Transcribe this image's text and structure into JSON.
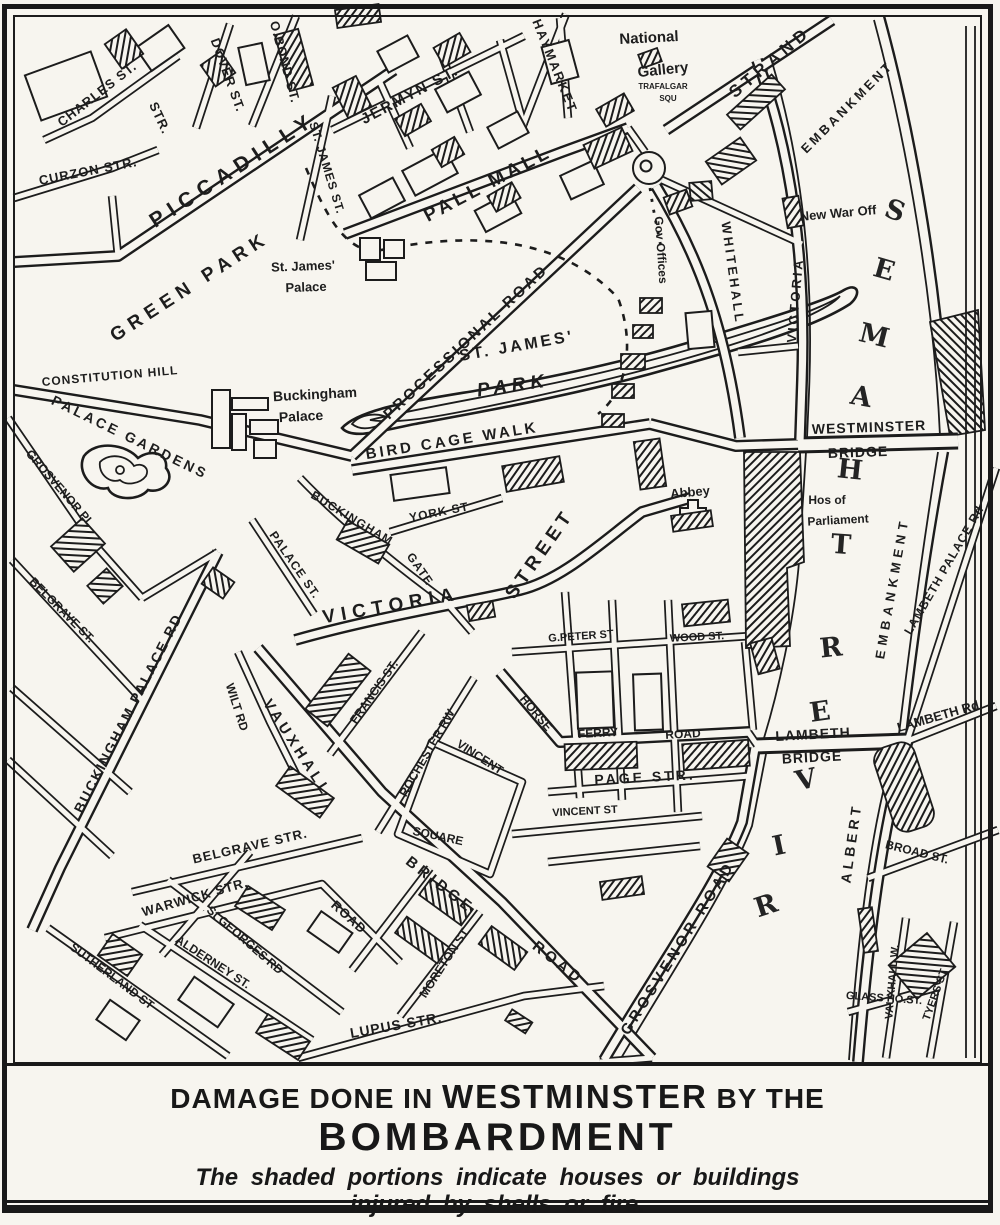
{
  "colors": {
    "ink": "#1c1c1c",
    "paper": "#f7f5ef"
  },
  "caption": {
    "line1_prefix": "DAMAGE DONE IN ",
    "line1_emphasis": "WESTMINSTER",
    "line1_suffix": " BY THE",
    "line2": "BOMBARDMENT",
    "note1": "The shaded portions indicate houses or buildings",
    "note2": "injured by shells or fire."
  },
  "labels": [
    {
      "name": "charles-street",
      "text": "CHARLES ST.",
      "x": 97,
      "y": 94,
      "rot": -38,
      "size": 13,
      "ls": 1
    },
    {
      "name": "str-fragment",
      "text": "STR.",
      "x": 160,
      "y": 118,
      "rot": 65,
      "size": 13,
      "ls": 1
    },
    {
      "name": "curzon-street",
      "text": "CURZON STR.",
      "x": 88,
      "y": 171,
      "rot": -11,
      "size": 13,
      "ls": 1
    },
    {
      "name": "dover-street",
      "text": "DOVER ST.",
      "x": 228,
      "y": 75,
      "rot": 70,
      "size": 13,
      "ls": 1
    },
    {
      "name": "old-bond-street",
      "text": "O.BOND ST.",
      "x": 285,
      "y": 62,
      "rot": 75,
      "size": 13,
      "ls": 1
    },
    {
      "name": "piccadilly",
      "text": "PICCADILLY",
      "x": 233,
      "y": 170,
      "rot": -33,
      "size": 21,
      "ls": 7
    },
    {
      "name": "st-james-street",
      "text": "ST. JAMES ST.",
      "x": 327,
      "y": 168,
      "rot": 73,
      "size": 12,
      "ls": 1
    },
    {
      "name": "jermyn-street",
      "text": "JERMYN ST.",
      "x": 410,
      "y": 95,
      "rot": -28,
      "size": 15,
      "ls": 2
    },
    {
      "name": "haymarket",
      "text": "HAYMARKET",
      "x": 555,
      "y": 66,
      "rot": 68,
      "size": 13,
      "ls": 2
    },
    {
      "name": "pall-mall",
      "text": "PALL MALL",
      "x": 488,
      "y": 184,
      "rot": -28,
      "size": 19,
      "ls": 4
    },
    {
      "name": "national-gallery-line1",
      "text": "National",
      "x": 649,
      "y": 38,
      "rot": -3,
      "size": 15
    },
    {
      "name": "national-gallery-line2",
      "text": "Gallery",
      "x": 663,
      "y": 70,
      "rot": -6,
      "size": 15
    },
    {
      "name": "trafalgar-square-line1",
      "text": "TRAFALGAR",
      "x": 663,
      "y": 87,
      "rot": 0,
      "size": 8
    },
    {
      "name": "trafalgar-square-line2",
      "text": "SQU",
      "x": 668,
      "y": 99,
      "rot": 0,
      "size": 8
    },
    {
      "name": "strand",
      "text": "STRAND",
      "x": 770,
      "y": 62,
      "rot": -40,
      "size": 17,
      "ls": 5
    },
    {
      "name": "victoria-embankment-part1",
      "text": "VICTORIA",
      "x": 795,
      "y": 300,
      "rot": -85,
      "size": 13,
      "ls": 3
    },
    {
      "name": "victoria-embankment-part2",
      "text": "EMBANKMENT",
      "x": 847,
      "y": 107,
      "rot": -45,
      "size": 13,
      "ls": 3
    },
    {
      "name": "new-war-office",
      "text": "New War Off",
      "x": 838,
      "y": 213,
      "rot": -5,
      "size": 13
    },
    {
      "name": "whitehall",
      "text": "WHITEHALL",
      "x": 733,
      "y": 273,
      "rot": 82,
      "size": 13,
      "ls": 3
    },
    {
      "name": "gov-offices",
      "text": "Gov Offices",
      "x": 661,
      "y": 250,
      "rot": 86,
      "size": 12
    },
    {
      "name": "green-park",
      "text": "GREEN PARK",
      "x": 190,
      "y": 287,
      "rot": -33,
      "size": 19,
      "ls": 6
    },
    {
      "name": "st-james-palace-line1",
      "text": "St. James'",
      "x": 303,
      "y": 266,
      "rot": -2,
      "size": 13
    },
    {
      "name": "st-james-palace-line2",
      "text": "Palace",
      "x": 306,
      "y": 287,
      "rot": -2,
      "size": 13
    },
    {
      "name": "processional-road",
      "text": "PROCESSIONAL ROAD",
      "x": 466,
      "y": 342,
      "rot": -43,
      "size": 15,
      "ls": 3
    },
    {
      "name": "constitution-hill",
      "text": "CONSTITUTION HILL",
      "x": 110,
      "y": 376,
      "rot": -5,
      "size": 12,
      "ls": 1
    },
    {
      "name": "palace-gardens",
      "text": "PALACE GARDENS",
      "x": 130,
      "y": 437,
      "rot": 26,
      "size": 14,
      "ls": 3
    },
    {
      "name": "buckingham-palace-line1",
      "text": "Buckingham",
      "x": 315,
      "y": 394,
      "rot": -3,
      "size": 14
    },
    {
      "name": "buckingham-palace-line2",
      "text": "Palace",
      "x": 301,
      "y": 416,
      "rot": -3,
      "size": 14
    },
    {
      "name": "st-james-park-line1",
      "text": "ST. JAMES'",
      "x": 517,
      "y": 347,
      "rot": -10,
      "size": 16,
      "ls": 3
    },
    {
      "name": "st-james-park-line2",
      "text": "PARK",
      "x": 513,
      "y": 386,
      "rot": -8,
      "size": 19,
      "ls": 5,
      "italic": true
    },
    {
      "name": "bird-cage-walk",
      "text": "BIRD CAGE WALK",
      "x": 452,
      "y": 441,
      "rot": -9,
      "size": 15,
      "ls": 3
    },
    {
      "name": "york-street",
      "text": "YORK ST",
      "x": 439,
      "y": 512,
      "rot": -11,
      "size": 12,
      "ls": 1
    },
    {
      "name": "buckingham-gate-part1",
      "text": "BUCKINGHAM",
      "x": 352,
      "y": 518,
      "rot": 31,
      "size": 12,
      "ls": 1
    },
    {
      "name": "buckingham-gate-part2",
      "text": "GATE",
      "x": 420,
      "y": 569,
      "rot": 55,
      "size": 12,
      "ls": 1
    },
    {
      "name": "palace-street",
      "text": "PALACE ST.",
      "x": 295,
      "y": 565,
      "rot": 55,
      "size": 12,
      "ls": 1
    },
    {
      "name": "victoria-street-part1",
      "text": "VICTORIA",
      "x": 391,
      "y": 606,
      "rot": -10,
      "size": 19,
      "ls": 6
    },
    {
      "name": "victoria-street-part2",
      "text": "STREET",
      "x": 540,
      "y": 554,
      "rot": -55,
      "size": 19,
      "ls": 5
    },
    {
      "name": "westminster-bridge-line1",
      "text": "WESTMINSTER",
      "x": 869,
      "y": 427,
      "rot": -2,
      "size": 14,
      "ls": 1
    },
    {
      "name": "westminster-bridge-line2",
      "text": "BRIDGE",
      "x": 858,
      "y": 452,
      "rot": -2,
      "size": 14,
      "ls": 1
    },
    {
      "name": "abbey",
      "text": "Abbey",
      "x": 690,
      "y": 492,
      "rot": -5,
      "size": 13
    },
    {
      "name": "houses-of-parliament-line1",
      "text": "Hos of",
      "x": 827,
      "y": 500,
      "rot": 0,
      "size": 12
    },
    {
      "name": "houses-of-parliament-line2",
      "text": "Parliament",
      "x": 838,
      "y": 520,
      "rot": -3,
      "size": 12
    },
    {
      "name": "gt-peter-street",
      "text": "G.PETER ST",
      "x": 581,
      "y": 637,
      "rot": -4,
      "size": 11
    },
    {
      "name": "wood-street",
      "text": "WOOD ST.",
      "x": 697,
      "y": 638,
      "rot": -3,
      "size": 11
    },
    {
      "name": "horseferry-road-part1",
      "text": "HORSE",
      "x": 536,
      "y": 713,
      "rot": 50,
      "size": 12
    },
    {
      "name": "horseferry-road-part2",
      "text": "FERRY",
      "x": 598,
      "y": 733,
      "rot": -3,
      "size": 12
    },
    {
      "name": "horseferry-road-part3",
      "text": "ROAD",
      "x": 683,
      "y": 734,
      "rot": -3,
      "size": 12
    },
    {
      "name": "page-street",
      "text": "PAGE STR.",
      "x": 645,
      "y": 777,
      "rot": -3,
      "size": 14,
      "ls": 3
    },
    {
      "name": "vincent-street",
      "text": "VINCENT ST",
      "x": 585,
      "y": 812,
      "rot": -3,
      "size": 11
    },
    {
      "name": "vincent-square-part1",
      "text": "VINCENT",
      "x": 480,
      "y": 757,
      "rot": 33,
      "size": 12
    },
    {
      "name": "vincent-square-part2",
      "text": "SQUARE",
      "x": 438,
      "y": 836,
      "rot": 12,
      "size": 12
    },
    {
      "name": "francis-street",
      "text": "FRANCIS ST.",
      "x": 374,
      "y": 692,
      "rot": -55,
      "size": 12
    },
    {
      "name": "rochester-row",
      "text": "ROCHESTER RW",
      "x": 427,
      "y": 753,
      "rot": -60,
      "size": 12
    },
    {
      "name": "wilton-road",
      "text": "WILT RD",
      "x": 237,
      "y": 707,
      "rot": 72,
      "size": 12
    },
    {
      "name": "vauxhall-bridge-road-part1",
      "text": "VAUXHALL",
      "x": 297,
      "y": 748,
      "rot": 57,
      "size": 15,
      "ls": 4
    },
    {
      "name": "vauxhall-bridge-road-part2",
      "text": "BRIDGE",
      "x": 440,
      "y": 885,
      "rot": 38,
      "size": 15,
      "ls": 4
    },
    {
      "name": "vauxhall-bridge-road-part3",
      "text": "ROAD",
      "x": 558,
      "y": 963,
      "rot": 38,
      "size": 15,
      "ls": 4
    },
    {
      "name": "belgrave-street",
      "text": "BELGRAVE ST.",
      "x": 62,
      "y": 610,
      "rot": 45,
      "size": 12
    },
    {
      "name": "grosvenor-place",
      "text": "GROSVENOR PL",
      "x": 60,
      "y": 488,
      "rot": 49,
      "size": 12
    },
    {
      "name": "buckingham-palace-road",
      "text": "BUCKINGHAM PALACE RD",
      "x": 128,
      "y": 713,
      "rot": -63,
      "size": 14,
      "ls": 2
    },
    {
      "name": "belgrave-str",
      "text": "BELGRAVE STR.",
      "x": 250,
      "y": 846,
      "rot": -13,
      "size": 13,
      "ls": 1
    },
    {
      "name": "warwick-str",
      "text": "WARWICK STR.",
      "x": 195,
      "y": 897,
      "rot": -16,
      "size": 13,
      "ls": 1
    },
    {
      "name": "road-fragment",
      "text": "ROAD",
      "x": 349,
      "y": 917,
      "rot": 42,
      "size": 13,
      "ls": 1
    },
    {
      "name": "st-georges-road",
      "text": "St GEORGES RD",
      "x": 245,
      "y": 940,
      "rot": 41,
      "size": 12
    },
    {
      "name": "alderney-street",
      "text": "ALDERNEY ST.",
      "x": 213,
      "y": 962,
      "rot": 33,
      "size": 12
    },
    {
      "name": "sutherland-street",
      "text": "SUTHERLAND ST",
      "x": 112,
      "y": 976,
      "rot": 37,
      "size": 12
    },
    {
      "name": "lupus-street",
      "text": "LUPUS STR.",
      "x": 396,
      "y": 1025,
      "rot": -10,
      "size": 14,
      "ls": 1
    },
    {
      "name": "moreton-street",
      "text": "MORETON ST",
      "x": 444,
      "y": 963,
      "rot": -57,
      "size": 12
    },
    {
      "name": "grosvenor-road",
      "text": "GROSVENOR ROAD",
      "x": 678,
      "y": 948,
      "rot": -58,
      "size": 15,
      "ls": 4
    },
    {
      "name": "lambeth-bridge-line1",
      "text": "LAMBETH",
      "x": 813,
      "y": 734,
      "rot": -3,
      "size": 14,
      "ls": 1
    },
    {
      "name": "lambeth-bridge-line2",
      "text": "BRIDGE",
      "x": 812,
      "y": 757,
      "rot": -3,
      "size": 14,
      "ls": 1
    },
    {
      "name": "lambeth-road",
      "text": "LAMBETH Rd",
      "x": 938,
      "y": 716,
      "rot": -16,
      "size": 13
    },
    {
      "name": "albert-embankment-part1",
      "text": "ALBERT",
      "x": 851,
      "y": 843,
      "rot": -82,
      "size": 14,
      "ls": 4
    },
    {
      "name": "albert-embankment-part2",
      "text": "EMBANKMENT",
      "x": 892,
      "y": 588,
      "rot": -80,
      "size": 13,
      "ls": 5
    },
    {
      "name": "lambeth-palace-road",
      "text": "LAMBETH PALACE Rd",
      "x": 944,
      "y": 570,
      "rot": -60,
      "size": 12,
      "ls": 1
    },
    {
      "name": "broad-street",
      "text": "BROAD ST.",
      "x": 917,
      "y": 852,
      "rot": 14,
      "size": 12
    },
    {
      "name": "glasshouse-street",
      "text": "GLASS HO.ST.",
      "x": 884,
      "y": 999,
      "rot": 4,
      "size": 11
    },
    {
      "name": "vauxhall-walk",
      "text": "VAUXHALL W.",
      "x": 893,
      "y": 982,
      "rot": -85,
      "size": 11
    },
    {
      "name": "tyers-street",
      "text": "TYERS ST",
      "x": 936,
      "y": 995,
      "rot": -70,
      "size": 11
    }
  ],
  "river_letters": [
    {
      "ch": "R",
      "x": 766,
      "y": 906,
      "rot": -18
    },
    {
      "ch": "I",
      "x": 779,
      "y": 846,
      "rot": -12
    },
    {
      "ch": "V",
      "x": 806,
      "y": 780,
      "rot": -12
    },
    {
      "ch": "E",
      "x": 820,
      "y": 712,
      "rot": -8
    },
    {
      "ch": "R",
      "x": 831,
      "y": 648,
      "rot": -6
    },
    {
      "ch": "T",
      "x": 841,
      "y": 545,
      "rot": 4
    },
    {
      "ch": "H",
      "x": 850,
      "y": 470,
      "rot": 6
    },
    {
      "ch": "A",
      "x": 861,
      "y": 397,
      "rot": 10
    },
    {
      "ch": "M",
      "x": 874,
      "y": 336,
      "rot": 14
    },
    {
      "ch": "E",
      "x": 884,
      "y": 270,
      "rot": 16
    },
    {
      "ch": "S",
      "x": 895,
      "y": 211,
      "rot": 20
    }
  ]
}
